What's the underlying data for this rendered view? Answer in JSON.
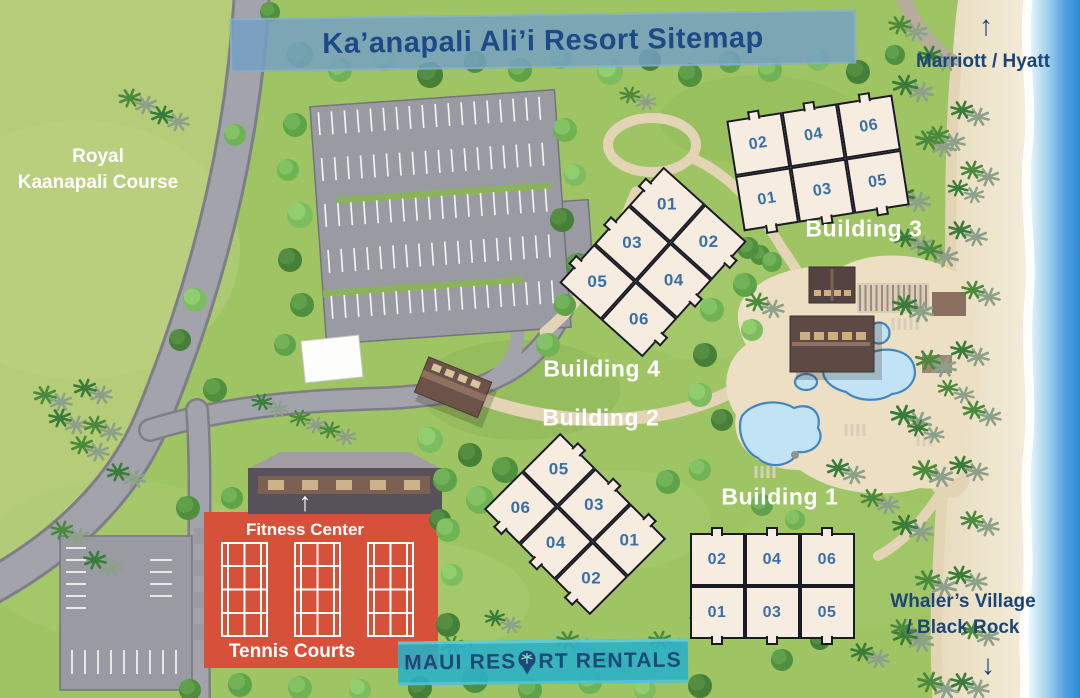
{
  "title": "Ka’anapali Ali’i Resort Sitemap",
  "area_labels": {
    "golf": {
      "line1": "Royal",
      "line2": "Kaanapali Course"
    },
    "north_neighbor": "Marriott / Hyatt",
    "south_neighbor": {
      "line1": "Whaler’s Village",
      "line2": "/ Black Rock"
    },
    "fitness_center": "Fitness Center",
    "tennis_courts": "Tennis Courts"
  },
  "icons": {
    "up_arrow": "↑",
    "down_arrow": "↓",
    "logo_pin": "palm-tree-map-pin"
  },
  "buildings": [
    {
      "id": "building-1",
      "label": "Building 1",
      "units": [
        [
          "02",
          "04",
          "06"
        ],
        [
          "01",
          "03",
          "05"
        ]
      ]
    },
    {
      "id": "building-2",
      "label": "Building 2",
      "units": [
        [
          "06",
          "05"
        ],
        [
          "04",
          "03"
        ],
        [
          "02",
          "01"
        ]
      ]
    },
    {
      "id": "building-3",
      "label": "Building 3",
      "units": [
        [
          "02",
          "04",
          "06"
        ],
        [
          "01",
          "03",
          "05"
        ]
      ]
    },
    {
      "id": "building-4",
      "label": "Building 4",
      "units": [
        [
          "01",
          "02"
        ],
        [
          "03",
          "04"
        ],
        [
          "05",
          "06"
        ]
      ]
    }
  ],
  "logo": {
    "part1": "Maui Res",
    "part2": "rt Rentals",
    "full_name": "Maui Resort Rentals"
  },
  "colors": {
    "banner_blue": "#74a0c4",
    "navy_text": "#1d4a86",
    "unit_number_blue": "#3a6fa8",
    "building_fill": "#f6ecdf",
    "tennis_red": "#d7503a",
    "logo_teal": "#29b0c8",
    "ocean_blue": "#2d8bd6",
    "grass_green": "#9ec463",
    "golf_green": "#b5cc78"
  }
}
